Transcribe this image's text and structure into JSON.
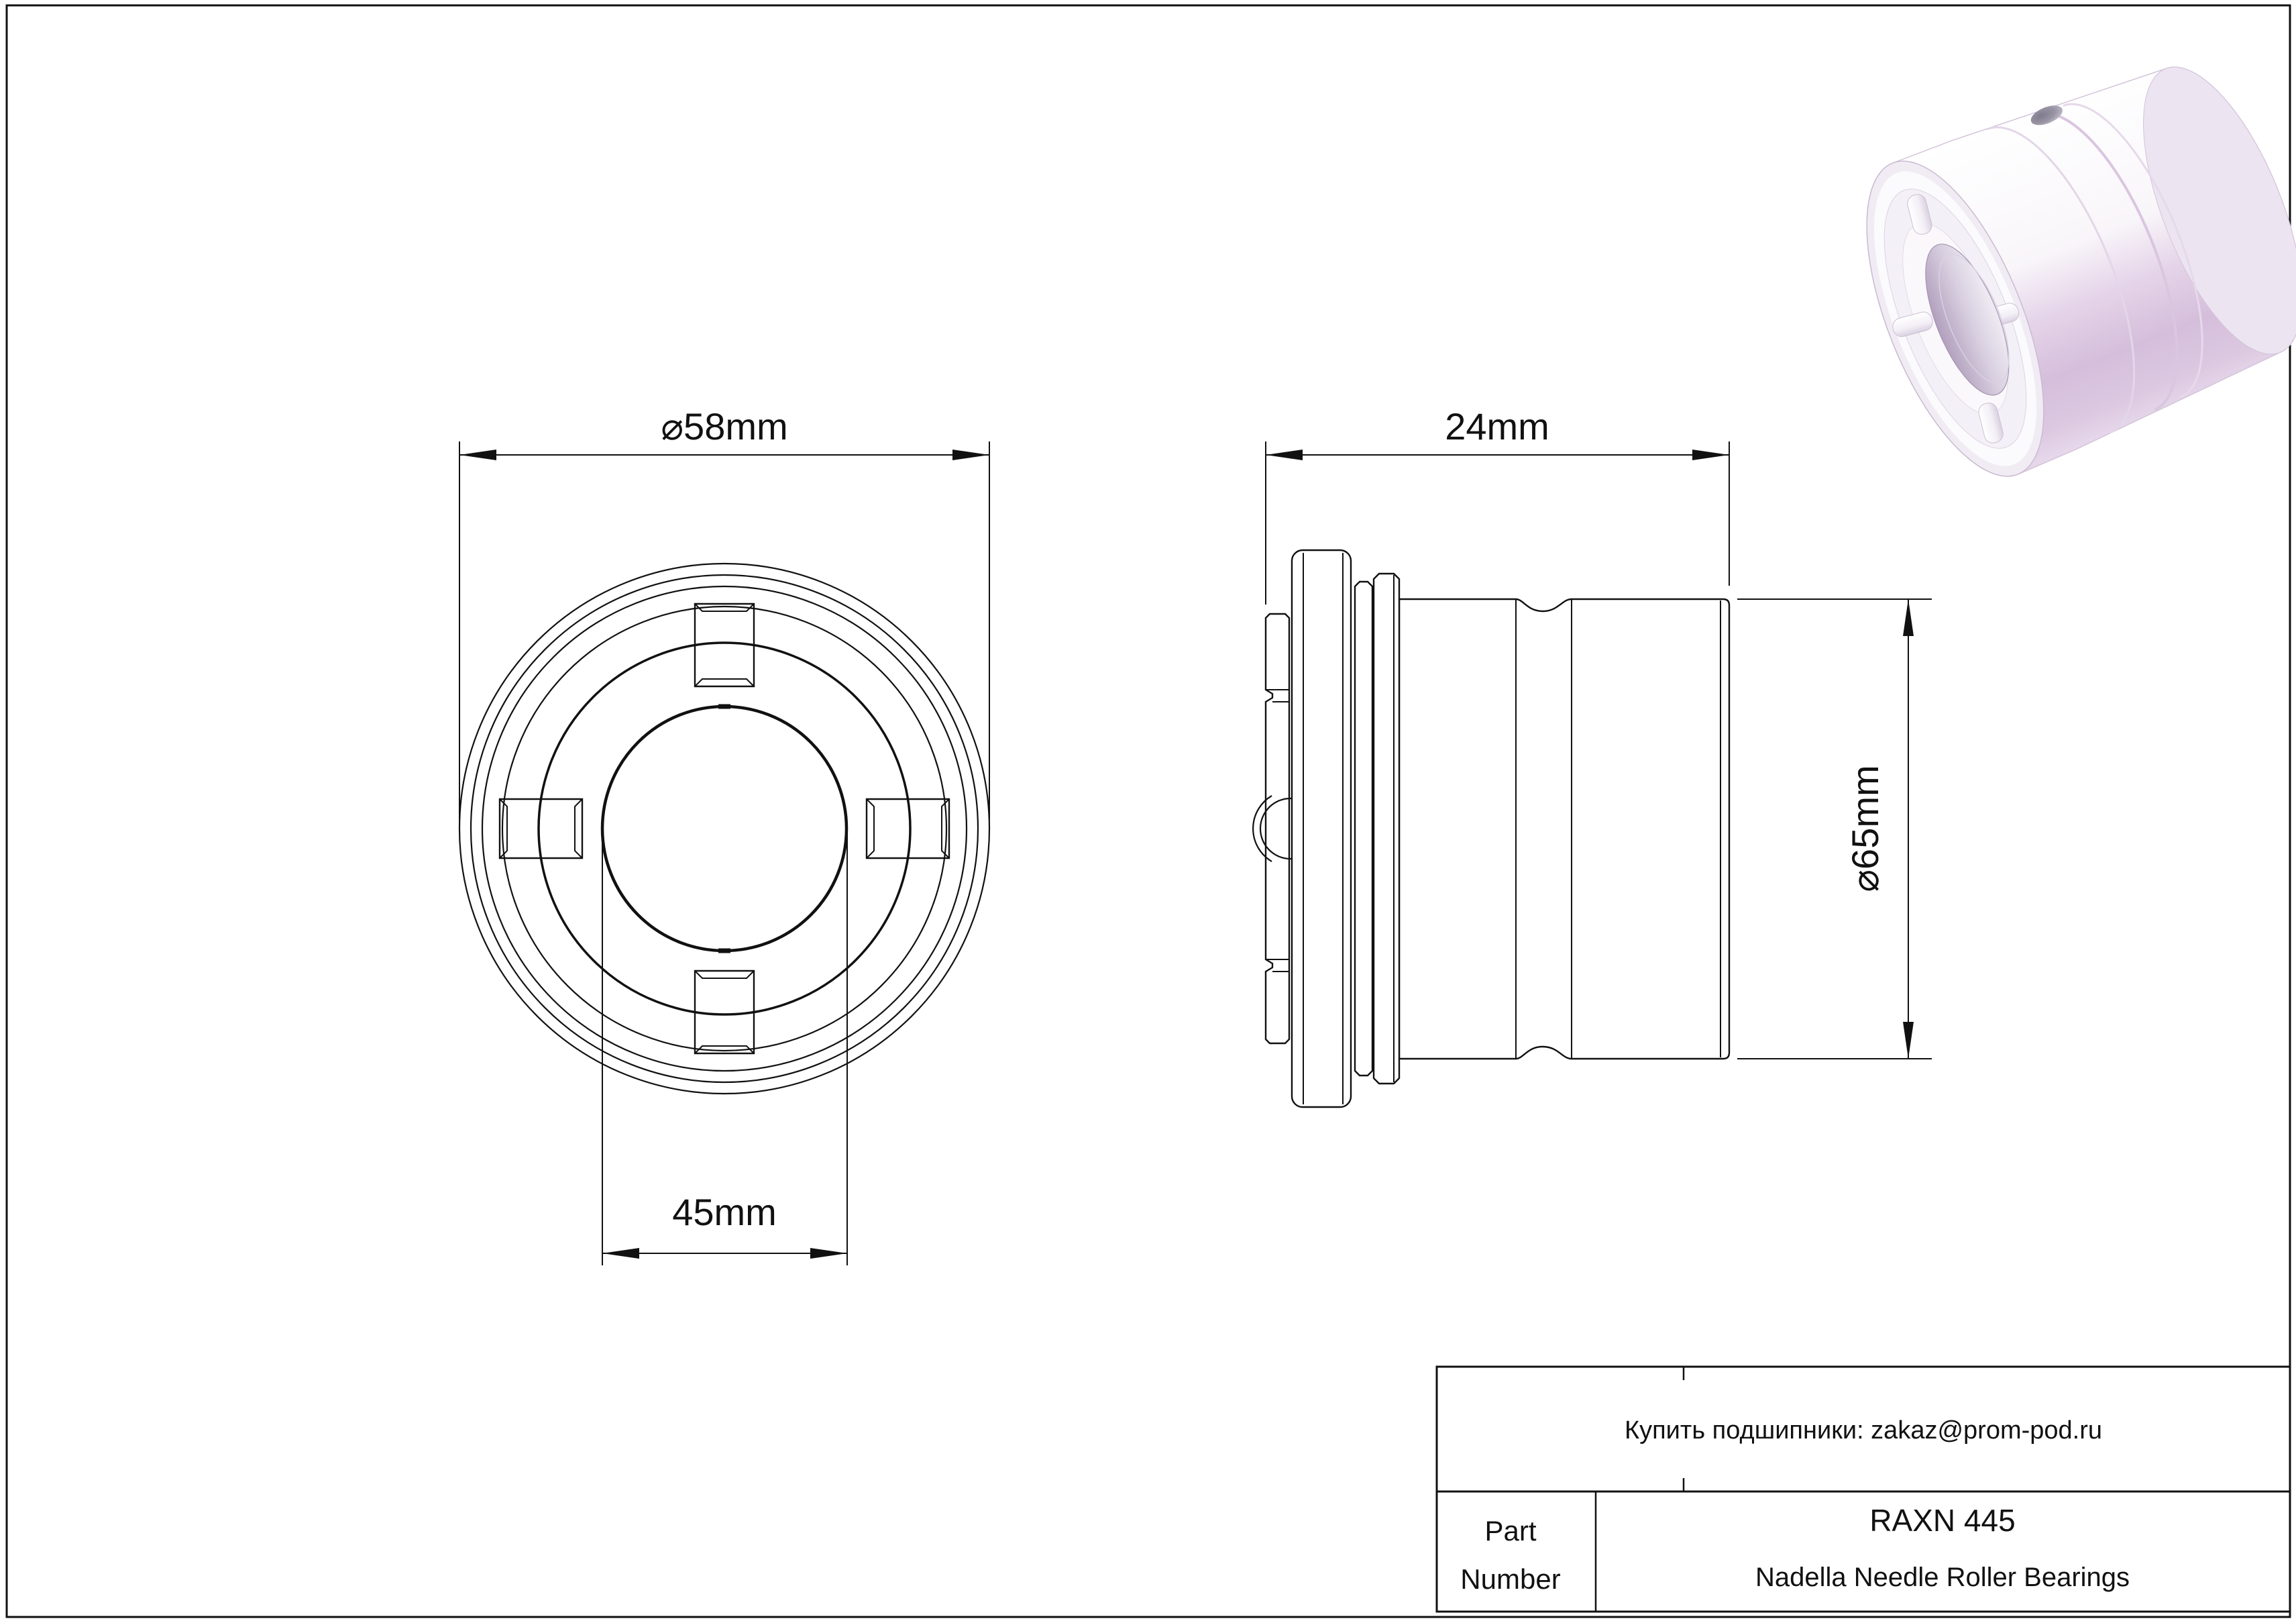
{
  "page": {
    "background": "#ffffff",
    "line_color": "#111111"
  },
  "front_view": {
    "outer_diameter_label": "⌀58mm",
    "bore_label": "45mm"
  },
  "side_view": {
    "width_label": "24mm",
    "outer_diameter_label": "⌀65mm"
  },
  "render_3d": {
    "subject": "needle roller bearing 3d render",
    "body_color": "#d8c3dd",
    "highlight_color": "#ffffff",
    "shadow_color": "#c3accb"
  },
  "title_block": {
    "contact_note": "Купить подшипники: zakaz@prom-pod.ru",
    "part_label_line1": "Part",
    "part_label_line2": "Number",
    "part_number": "RAXN 445",
    "series_name": "Nadella Needle Roller Bearings"
  }
}
